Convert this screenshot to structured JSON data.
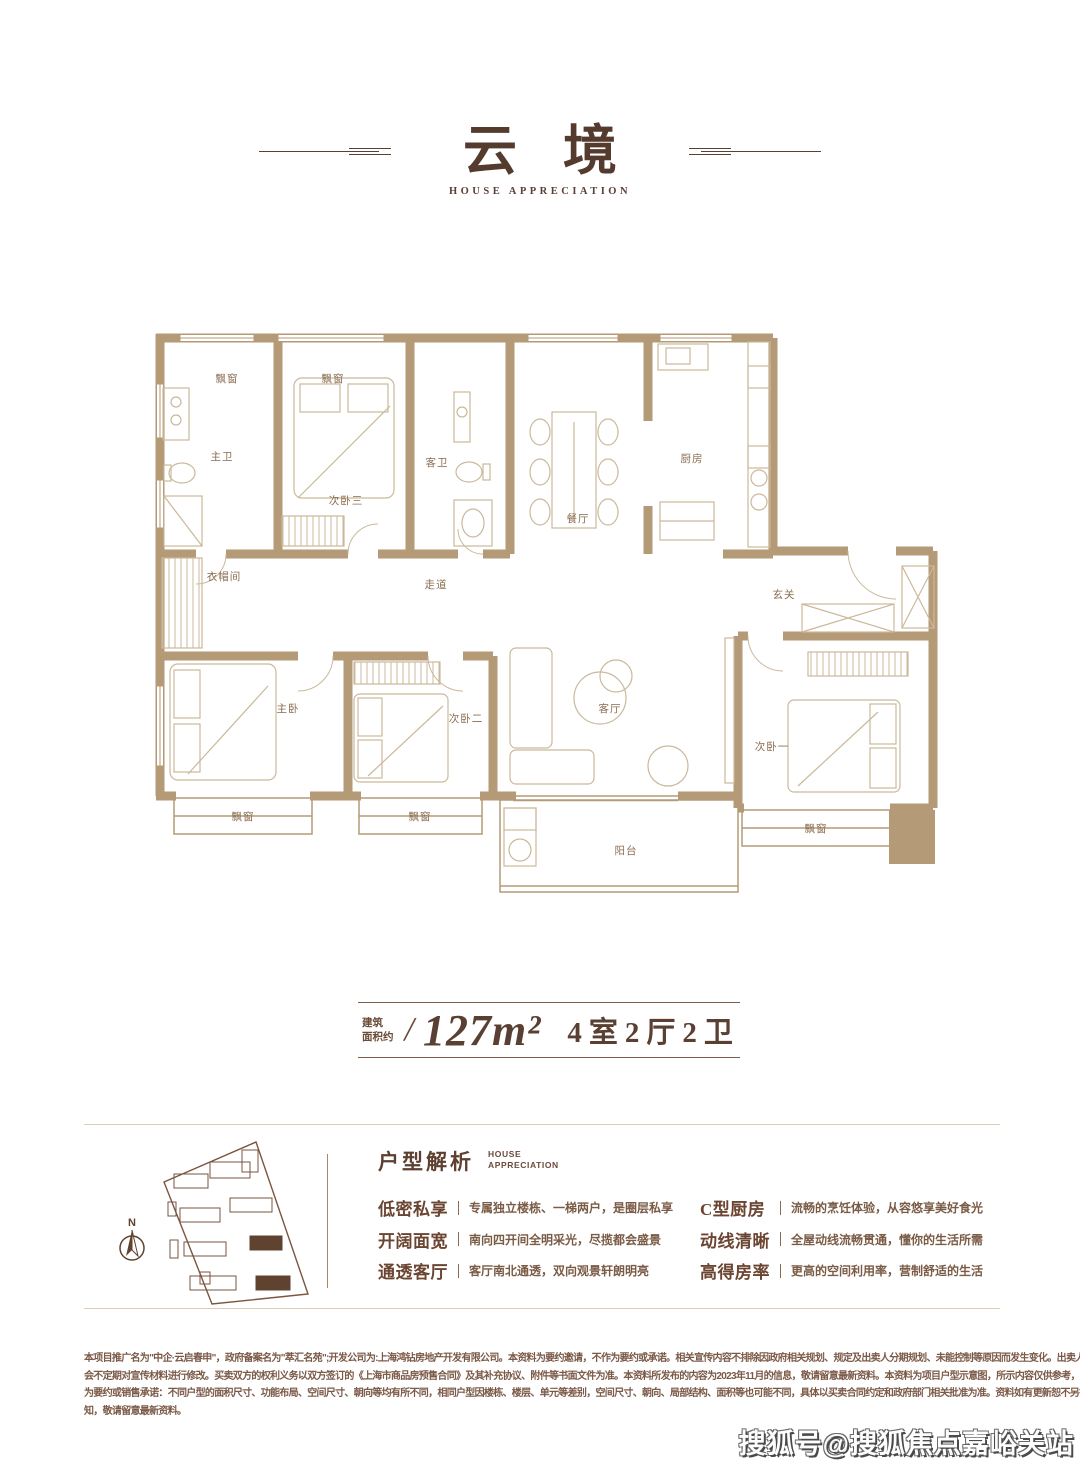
{
  "header": {
    "title": "云境",
    "subtitle": "HOUSE APPRECIATION"
  },
  "floor_plan": {
    "rooms": [
      {
        "label": "飘窗"
      },
      {
        "label": "飘窗"
      },
      {
        "label": "主卫"
      },
      {
        "label": "次卧三"
      },
      {
        "label": "客卫"
      },
      {
        "label": "餐厅"
      },
      {
        "label": "厨房"
      },
      {
        "label": "衣帽间"
      },
      {
        "label": "走道"
      },
      {
        "label": "玄关"
      },
      {
        "label": "主卧"
      },
      {
        "label": "次卧二"
      },
      {
        "label": "客厅"
      },
      {
        "label": "次卧一"
      },
      {
        "label": "飘窗"
      },
      {
        "label": "飘窗"
      },
      {
        "label": "阳台"
      },
      {
        "label": "飘窗"
      }
    ]
  },
  "area_band": {
    "prefix_top": "建筑",
    "prefix_bottom": "面积约",
    "slash": "/",
    "area": "127m²",
    "layout": "4室2厅2卫"
  },
  "site_plan": {
    "north": "N"
  },
  "analysis": {
    "heading": "户型解析",
    "en_top": "HOUSE",
    "en_bottom": "APPRECIATION",
    "features": [
      {
        "term": "低密私享",
        "desc": "专属独立楼栋、一梯两户，是圈层私享"
      },
      {
        "term": "开阔面宽",
        "desc": "南向四开间全明采光，尽揽都会盛景"
      },
      {
        "term": "通透客厅",
        "desc": "客厅南北通透，双向观景轩朗明亮"
      },
      {
        "term": "C型厨房",
        "desc": "流畅的烹饪体验，从容悠享美好食光"
      },
      {
        "term": "动线清晰",
        "desc": "全屋动线流畅贯通，懂你的生活所需"
      },
      {
        "term": "高得房率",
        "desc": "更高的空间利用率，营制舒适的生活"
      }
    ]
  },
  "disclaimer": {
    "lines": [
      "本项目推广名为\"中企·云启春申\"，政府备案名为\"萃汇名苑\";开发公司为:上海鸿钻房地产开发有限公司。本资料为要约邀请，不作为要约或承诺。相关宣传内容不排除因政府相关规划、规定及出卖人分期规划、未能控制等原因而发生变化。出卖人可能",
      "会不定期对宣传材料进行修改。买卖双方的权利义务以双方签订的《上海市商品房预售合同》及其补充协议、附件等书面文件为准。本资料所发布的内容为2023年11月的信息，敬请留意最新资料。本资料为项目户型示意图，所示内容仅供参考，不作",
      "为要约或销售承诺：不同户型的面积尺寸、功能布局、空间尺寸、朝向等均有所不同，相同户型因楼栋、楼层、单元等差别，空间尺寸、朝向、局部结构、面积等也可能不同，具体以买卖合同约定和政府部门相关批准为准。资料如有更新恕不另行通",
      "知，敬请留意最新资料。"
    ]
  },
  "watermark": "搜狐号@搜狐焦点嘉峪关站",
  "colors": {
    "wall": "#b49a77",
    "furniture_line": "#cbb89b",
    "room_label": "#8a6c50",
    "accent_brown": "#553a2e",
    "hairline": "#dccdb6"
  }
}
